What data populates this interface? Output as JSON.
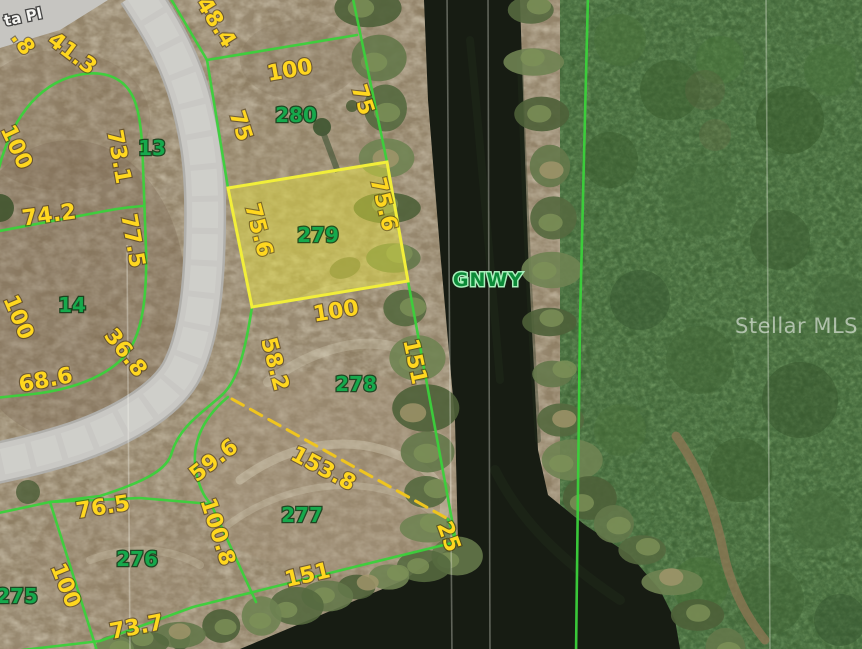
{
  "map": {
    "street_label": "ta Pl",
    "waterway_label": "GNWY",
    "watermark": "Stellar MLS",
    "highlighted_lot": "279",
    "colors": {
      "parcel_line": "#3bd13b",
      "dimension_text": "#ffd71f",
      "lot_number_text": "#16a94c",
      "highlight_fill": "#e8e43c",
      "highlight_border": "#f2ee3a",
      "dashed_line": "#efc51f",
      "water": "#171c13",
      "road": "#c9c8c4"
    },
    "lots": {
      "l13": "13",
      "l14": "14",
      "l275": "275",
      "l276": "276",
      "l277": "277",
      "l278": "278",
      "l279": "279",
      "l280": "280"
    },
    "dims": {
      "d48_4": "48.4",
      "d100_280": "100",
      "d75w": "75",
      "d75e": "75",
      "d_8": ".8",
      "d41_3": "41.3",
      "d73_1": "73.1",
      "d100_13": "100",
      "d74_2": "74.2",
      "d77_5": "77.5",
      "d100_14": "100",
      "d36_8": "36.8",
      "d68_6": "68.6",
      "d75_6w": "75.6",
      "d75_6e": "75.6",
      "d100_279": "100",
      "d58_2": "58.2",
      "d151e": "151",
      "d59_6": "59.6",
      "d100_8": "100.8",
      "d153_8": "153.8",
      "d151s": "151",
      "d25": "25",
      "d76_5": "76.5",
      "d100_275": "100",
      "d73_7": "73.7"
    }
  }
}
